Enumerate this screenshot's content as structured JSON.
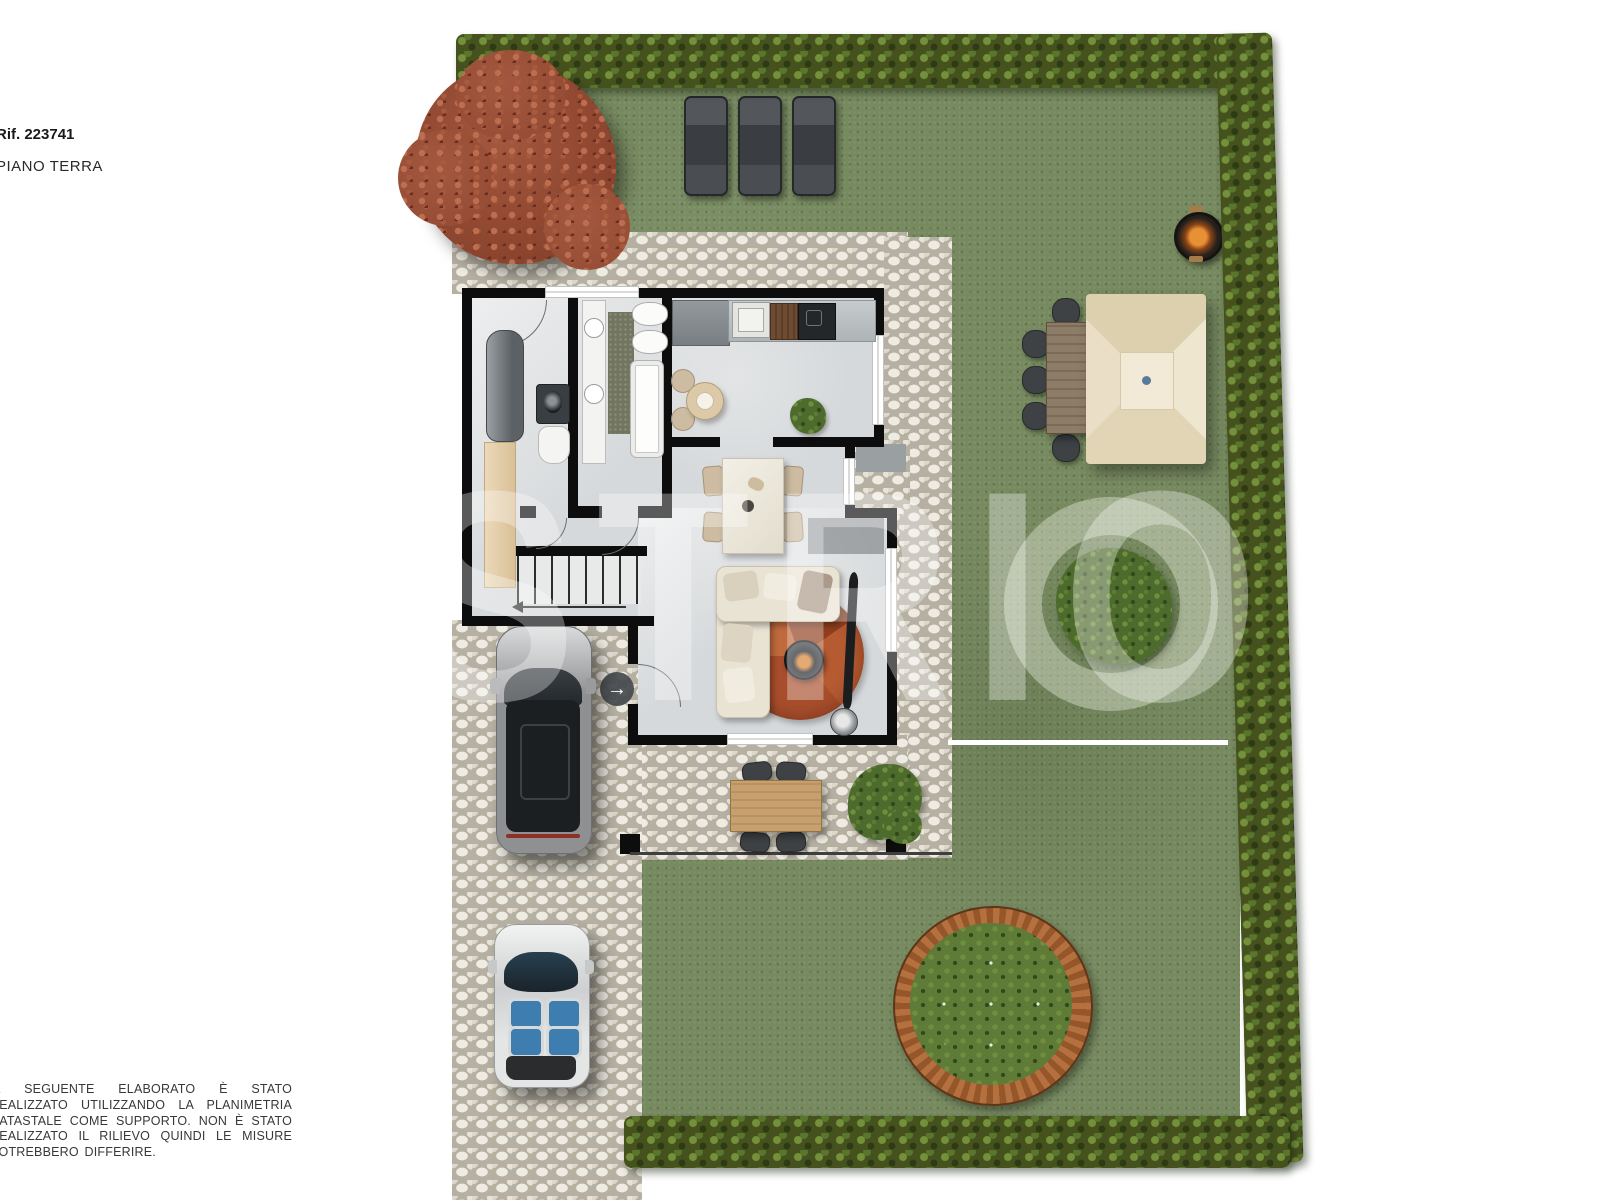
{
  "header": {
    "reference": "Rif. 223741",
    "floor_label": "PIANO TERRA"
  },
  "watermark": "STRIO",
  "disclaimer": "IL SEGUENTE ELABORATO È STATO REALIZZATO UTILIZZANDO LA PLANIMETRIA CATASTALE COME SUPPORTO. NON È STATO REALIZZATO IL RILIEVO QUINDI LE MISURE POTREBBERO DIFFERIRE.",
  "plan": {
    "entrance_arrow_glyph": "→",
    "colors": {
      "grass": "#76895f",
      "hedge": "#46521e",
      "cobblestone": "#ddd8cb",
      "wall": "#0d0d0e",
      "interior_floor": "#d6d9db",
      "rug_terracotta": "#b05330",
      "sofa_cream": "#e9e3d4",
      "outdoor_wood": "#c6a071",
      "umbrella_cream": "#e8ddc2",
      "tree_autumn_red": "#96482f",
      "planter_ring": "#b4713f",
      "suv_silver": "#b9babc",
      "convertible_white": "#e9eaea",
      "seat_blue": "#3d7db0"
    },
    "objects": [
      "autumn-tree",
      "perimeter-hedge",
      "sun-loungers",
      "fire-pit",
      "patio-umbrella",
      "garden-dining-table",
      "lawn-shrub-ring",
      "circular-wood-planter",
      "terrace-table-set",
      "terrace-shrub",
      "suv-car",
      "convertible-car",
      "corner-sofa",
      "round-rug",
      "wood-stove",
      "dining-table",
      "kitchen-counter",
      "bathroom",
      "laundry-room",
      "staircase",
      "cobblestone-driveway",
      "lawn"
    ]
  }
}
